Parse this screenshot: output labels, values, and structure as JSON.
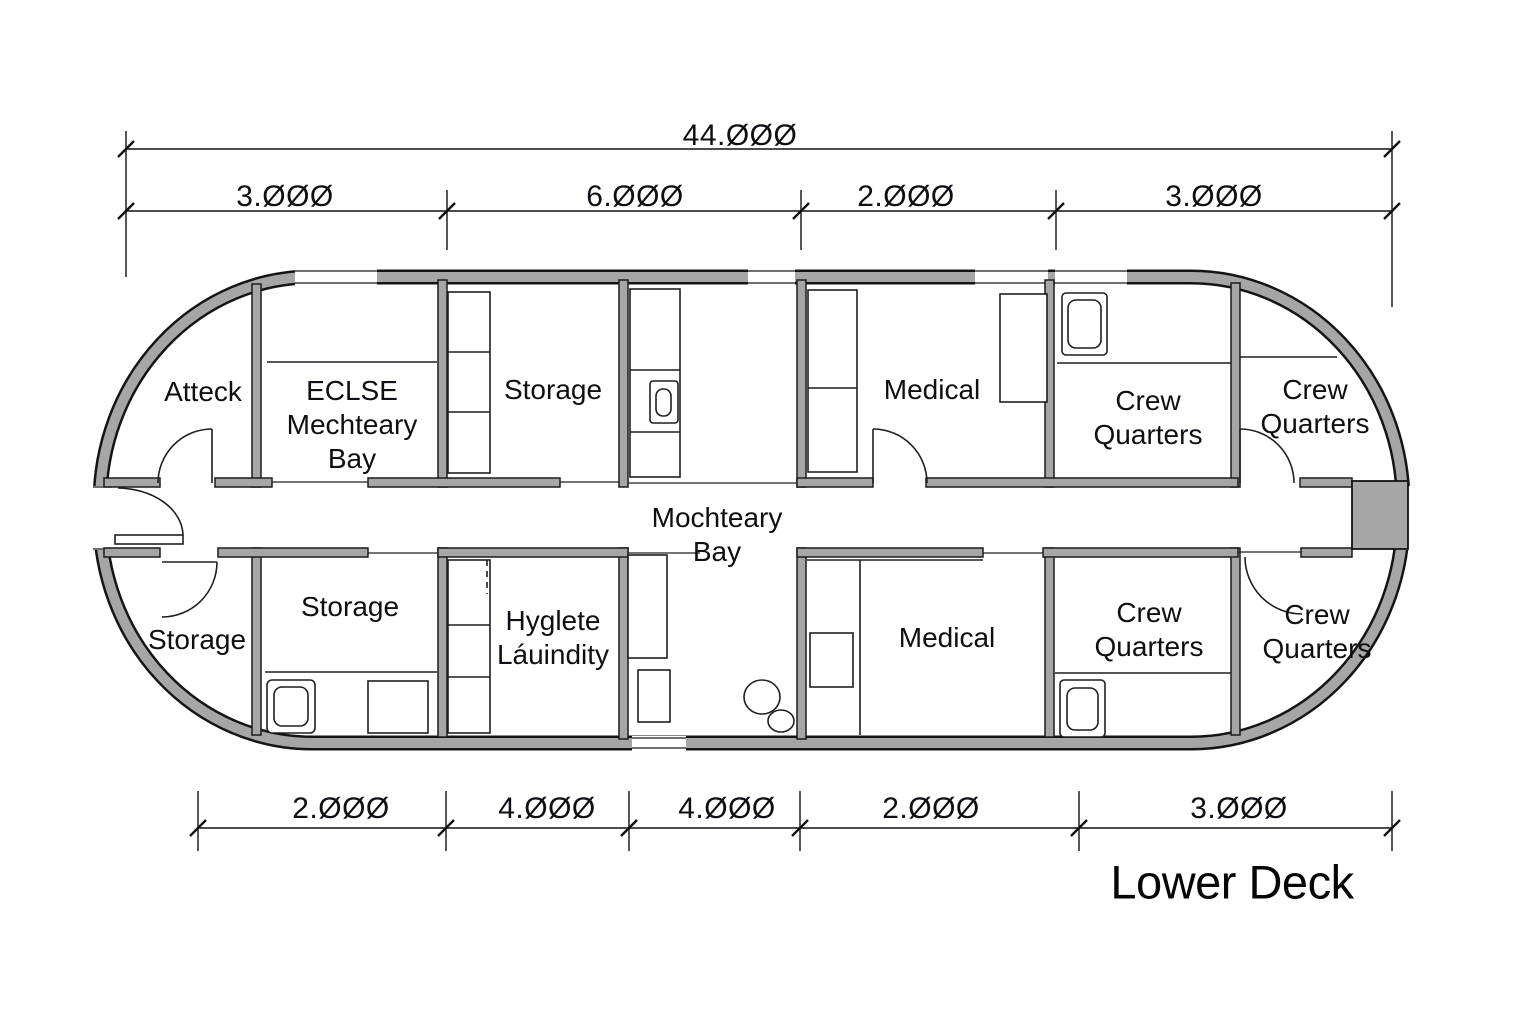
{
  "title": "Lower Deck",
  "dimensions": {
    "overall": "44.000",
    "top": [
      "3.000",
      "6.000",
      "2.000",
      "3.000"
    ],
    "bottom": [
      "2.000",
      "4.000",
      "4.000",
      "2.000",
      "3.000"
    ]
  },
  "rooms": {
    "atteck": "Atteck",
    "eclse_mechteary_bay": "ECLSE\nMechteary\nBay",
    "storage_top": "Storage",
    "medical_top": "Medical",
    "crew_quarters_top_middle": "Crew\nQuarters",
    "crew_quarters_top_right": "Crew\nQuarters",
    "mochteary_bay": "Mochteary\nBay",
    "storage_bottom_left": "Storage",
    "storage_bottom": "Storage",
    "hyglete_laundry": "Hyglete\nLáuindity",
    "medical_bottom": "Medical",
    "crew_quarters_bottom_middle": "Crew\nQuarters",
    "crew_quarters_bottom_right": "Crew\nQuarters"
  },
  "colors": {
    "wall": "#a6a6a6",
    "line": "#141414",
    "background": "#ffffff"
  }
}
